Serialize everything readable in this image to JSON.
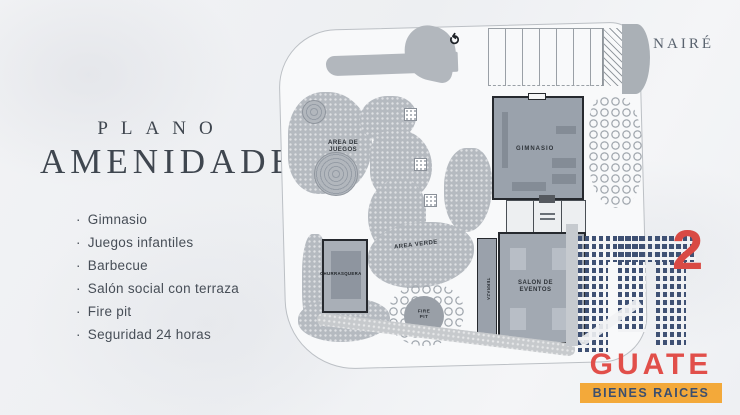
{
  "brand": {
    "name": "NAIRÉ"
  },
  "panel": {
    "title_small": "PLANO",
    "title_large": "AMENIDADES",
    "bullet": "·",
    "items": [
      "Gimnasio",
      "Juegos infantiles",
      "Barbecue",
      "Salón social con terraza",
      "Fire pit",
      "Seguridad 24 horas"
    ]
  },
  "plan": {
    "labels": {
      "area_juegos_line1": "AREA DE",
      "area_juegos_line2": "JUEGOS",
      "area_verde": "AREA VERDE",
      "churrasquera": "CHURRASQUERA",
      "gimnasio": "GIMNASIO",
      "salon_line1": "SALON DE",
      "salon_line2": "EVENTOS",
      "terraza": "TERRAZA",
      "fire_line1": "FIRE",
      "fire_line2": "PIT"
    }
  },
  "logo": {
    "exponent": "2",
    "name": "GUATE",
    "tagline": "BIENES RAICES",
    "colors": {
      "red": "#e14f4a",
      "orange": "#f3a93a",
      "navy": "#3f5174"
    }
  }
}
